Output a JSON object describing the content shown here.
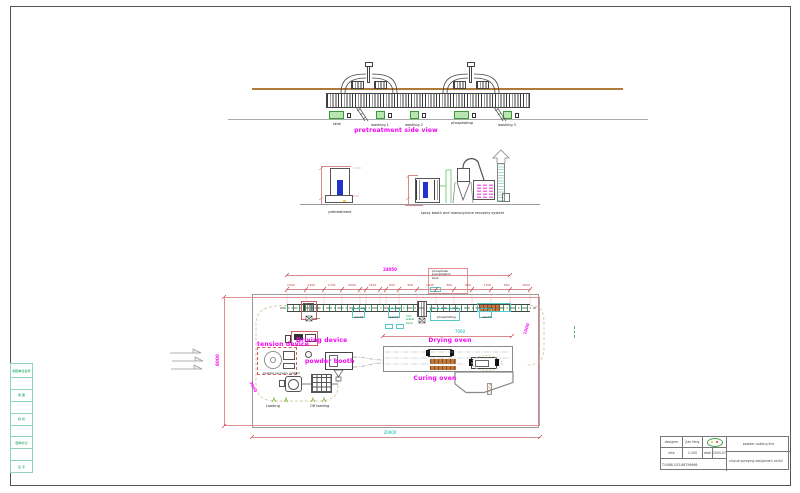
{
  "colors": {
    "label_magenta": "#f500f5",
    "dimension_red": "#c04040",
    "teal": "#00b2b2",
    "green_text": "#00a050",
    "tank_green": "#b8e6b0",
    "monorail_brown": "#b07b3a",
    "workpiece_blue": "#2233cc"
  },
  "side_view": {
    "title": "pretreatment side view",
    "tank_labels": [
      "skim",
      "washing 1",
      "washing 2",
      "phosphating",
      "washing 3"
    ]
  },
  "elevation": {
    "pretreatment_label": "pretreatment",
    "spray_label": "spray booth and monocyclone recovery system"
  },
  "plan": {
    "overall_dim": "24050",
    "dim_segments": [
      "1500",
      "2250",
      "1700",
      "2000",
      "1450",
      "600",
      "800",
      "1445",
      "600",
      "800",
      "1700",
      "650",
      "2000"
    ],
    "phosphate_note": [
      "phosphate",
      "precipitation",
      "tank"
    ],
    "hot_water_tank": [
      "hot",
      "water",
      "tank"
    ],
    "tank_labels": [
      "wash1",
      "wash2",
      "phosphating",
      "wash3"
    ],
    "driving_device": "Driving device",
    "tension_device": "tension device",
    "powder_booth": "powder booth",
    "powder_recovery": "powder recovery system",
    "drying_oven": "Drying oven",
    "curing_oven": "Curing oven",
    "loading": "Loading",
    "off_loading": "Off loading",
    "dim_bottom": "20000",
    "dim_left": "8000",
    "dim_oven": "7000",
    "dim_right_curve": "1000",
    "dim_left_curve": "3000"
  },
  "sidebar": {
    "cells": [
      "制图单位名称",
      "",
      "审 图",
      "",
      "校 核",
      "",
      "图样标记",
      "",
      "签 字"
    ]
  },
  "title_block": {
    "designer_label": "designer",
    "designer_value": "jian feng",
    "rate_label": "rate",
    "rate_value": "1:100",
    "date_label": "date",
    "date_value": "2005.07",
    "phone": "T:0086-523-88759666",
    "product": "powder coating line",
    "company": "xinyue spraying equipment co.ltd"
  }
}
